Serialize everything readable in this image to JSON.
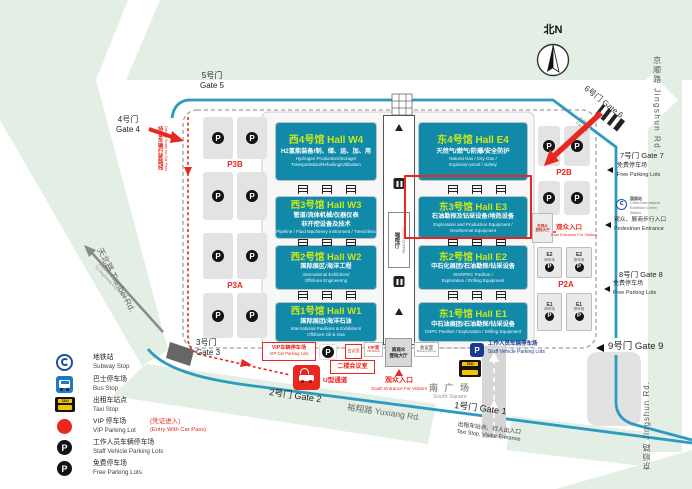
{
  "compass": {
    "label": "北N"
  },
  "icons": {
    "parking_letter": "P",
    "taxi_label": "TAXI"
  },
  "roads": {
    "jingshun_top": "京顺路 Jingshun Rd.",
    "jingshun_bottom": "京顺路 Jingshun Rd.",
    "tianbei": "天北路 Tianbei Rd.",
    "yuxiang": "裕翔路 Yuxiang Rd.",
    "expressway_zh": "去往京承高速路入口",
    "expressway_en": "To Jingcheng Expressway"
  },
  "route_note": {
    "zh": "持证车辆行驶路线",
    "en": "Driving Route for Car Pass"
  },
  "gates": {
    "g1": {
      "label": "1号门 Gate 1",
      "note_zh": "出租车站点、行人出入口",
      "note_en": "Taxi Stop,  Visitor Entrance"
    },
    "g2": {
      "label": "2号门 Gate 2"
    },
    "g3": {
      "zh": "3号门",
      "en": "Gate 3"
    },
    "g4": {
      "zh": "4号门",
      "en": "Gate 4"
    },
    "g5": {
      "zh": "5号门",
      "en": "Gate 5"
    },
    "g6": {
      "label": "6号门 Gate 6",
      "exit_zh": "车辆出口",
      "exit_en": "Car Exit"
    },
    "g7": {
      "label": "7号门 Gate 7",
      "note_zh": "免费停车场",
      "note_en": "Free Parking Lots"
    },
    "g8": {
      "label": "8号门 Gate 8",
      "note_zh": "免费停车场",
      "note_en": "Free Parking Lots"
    },
    "g9": {
      "label": "9号门 Gate 9"
    }
  },
  "halls": {
    "w4": {
      "title": "西4号馆 Hall W4",
      "zh": "H2氢能装备/制、储、运、加、用",
      "en1": "Hydrogen Production/Storage/",
      "en2": "Transportation/Refueling/Utilization"
    },
    "w3": {
      "title": "西3号馆 Hall W3",
      "zh": "管道/流体机械/仪器仪表",
      "zh2": "非开挖设备及技术",
      "en1": "Pipeline / Fluid Machinery Instrument / Trenchless"
    },
    "w2": {
      "title": "西2号馆 Hall W2",
      "zh": "国际展区/海洋工程",
      "en1": "International Exhibitors/",
      "en2": "Offshore Engineering"
    },
    "w1": {
      "title": "西1号馆 Hall W1",
      "zh": "国际展团/海洋石油",
      "en1": "International Pavilions & Exhibitors/",
      "en2": "Offshore Oil & Gas"
    },
    "e4": {
      "title": "东4号馆 Hall E4",
      "zh": "天然气/燃气/防爆/安全防护",
      "en1": "Natural Gas / City Gas /",
      "en2": "Explosion-proof / Safety"
    },
    "e3": {
      "title": "东3号馆 Hall E3",
      "zh": "石油勘探及钻采设备/地热设备",
      "en1": "Exploration and Production Equipment /",
      "en2": "Geothermal Equipment"
    },
    "e2": {
      "title": "东2号馆 Hall E2",
      "zh": "中石化展团/石油勘探/钻采设备",
      "en1": "SINOPEC Pavilion /",
      "en2": "Exploration / Drilling Equipment"
    },
    "e1": {
      "title": "东1号馆 Hall E1",
      "zh": "中石油展团/石油勘探/钻采设备",
      "en1": "CNPC Pavilion / Exploration / Drilling Equipment"
    }
  },
  "corridor": {
    "coffee_zh": "咖啡厅",
    "coffee_en": "COSTA COFFEE"
  },
  "parking": {
    "p3b": "P3B",
    "p3a": "P3A",
    "p2b": "P2B",
    "p2a": "P2A",
    "e2_name": "E2",
    "e1_name": "E1",
    "lot_zh": "停车场"
  },
  "east_side": {
    "hall_line1": "东观众",
    "hall_line2": "登陆大厅",
    "entrance_zh": "观众入口",
    "entrance_en": "East Entrance For Visitors",
    "station_zh": "国展站",
    "station_en1": "China International",
    "station_en2": "Exhibition Center",
    "station_en3": "Station",
    "pedestrian_zh": "观众、展商步行入口",
    "pedestrian_en": "Pedestrian Entrance"
  },
  "south": {
    "meeting2_zh": "会议室",
    "vip_room_zh": "VIP室",
    "vip_room_en": "VIP Room",
    "hall_line1": "南观众",
    "hall_line2": "登陆大厅",
    "meeting_zh": "会议室",
    "meeting_en": "Meeting Room",
    "entrance_zh": "观众入口",
    "entrance_en": "South Entrance For Visitors",
    "square_zh": "南 广 场",
    "square_en": "South Square",
    "floor2_meeting": "二楼会议室",
    "staff_zh": "工作人员车辆停车场",
    "staff_en": "Staff Vehicle Parking Lots",
    "vip_lot_zh": "VIP车辆停车场",
    "vip_lot_en": "VIP Car Parking Lots",
    "u_channel": "U型通道"
  },
  "legend": {
    "items": [
      {
        "icon": "subway-icon",
        "zh": "地铁站",
        "en": "Subway Stop"
      },
      {
        "icon": "bus-icon",
        "zh": "巴士停车场",
        "en": "Bus Stop"
      },
      {
        "icon": "taxi-icon",
        "zh": "出租车站点",
        "en": "Taxi Stop"
      },
      {
        "icon": "vip-parking-icon",
        "zh": "VIP 停车场",
        "en": "VIP Parking Lot",
        "note_zh": "(凭证进入)",
        "note_en": "(Entry With Car Pass)"
      },
      {
        "icon": "staff-parking-icon",
        "zh": "工作人员车辆停车场",
        "en": "Staff Vehicle Parking Lots"
      },
      {
        "icon": "free-parking-icon",
        "zh": "免费停车场",
        "en": "Free Parking Lots"
      }
    ]
  },
  "colors": {
    "hall_fill": "#1189a9",
    "hall_title": "#c9e81a",
    "road_blue": "#2d9bc1",
    "alert_red": "#e8281e",
    "map_green": "#e3efe4"
  }
}
